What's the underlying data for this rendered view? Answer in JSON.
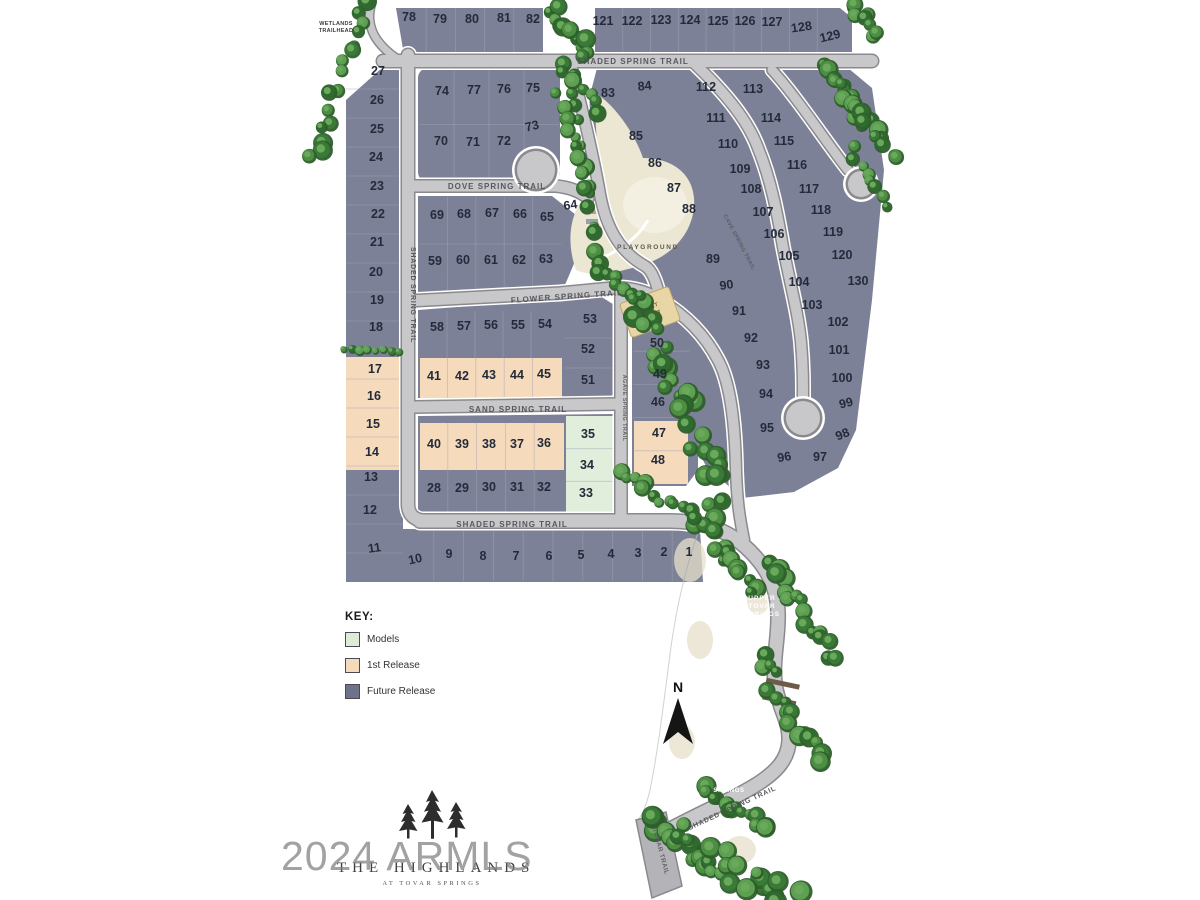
{
  "map": {
    "wetlands_line1": "WETLANDS",
    "wetlands_line2": "TRAILHEAD",
    "playground_label": "PLAYGROUND",
    "sport_court_line1": "SPORT",
    "sport_court_line2": "COURT",
    "upper_springs_line1": "UPPER",
    "upper_springs_line2": "TOVAR",
    "upper_springs_line3": "SPRINGS",
    "middle_springs_line1": "MIDDLE",
    "middle_springs_line2": "TOVAR",
    "middle_springs_line3": "SPRINGS",
    "north_label": "N"
  },
  "streets": {
    "shaded_top": "SHADED SPRING TRAIL",
    "dove": "DOVE SPRING TRAIL",
    "flower": "FLOWER SPRING TRAIL",
    "sand": "SAND SPRING TRAIL",
    "shaded_bottom": "SHADED SPRING TRAIL",
    "shaded_left": "SHADED SPRING TRAIL",
    "agave": "AGAVE SPRING TRAIL",
    "cave": "CAVE SPRING TRAIL",
    "shaded_diag": "SHADED SPRING TRAIL",
    "tovar": "TOVAR TRAIL"
  },
  "legend": {
    "title": "KEY:",
    "items": [
      {
        "label": "Models",
        "color": "#dcedd6",
        "category": "model"
      },
      {
        "label": "1st Release",
        "color": "#f5dabc",
        "category": "first"
      },
      {
        "label": "Future Release",
        "color": "#6f7389",
        "category": "future"
      }
    ]
  },
  "logo": {
    "name": "THE HIGHLANDS",
    "tagline": "AT TOVAR SPRINGS"
  },
  "watermark": "2024 ARMLS",
  "lots": [
    {
      "n": "1",
      "x": 689,
      "y": 556,
      "t": "future"
    },
    {
      "n": "2",
      "x": 664,
      "y": 556,
      "t": "future"
    },
    {
      "n": "3",
      "x": 638,
      "y": 557,
      "t": "future"
    },
    {
      "n": "4",
      "x": 611,
      "y": 558,
      "t": "future"
    },
    {
      "n": "5",
      "x": 581,
      "y": 559,
      "t": "future"
    },
    {
      "n": "6",
      "x": 549,
      "y": 560,
      "t": "future"
    },
    {
      "n": "7",
      "x": 516,
      "y": 560,
      "t": "future"
    },
    {
      "n": "8",
      "x": 483,
      "y": 560,
      "t": "future"
    },
    {
      "n": "9",
      "x": 449,
      "y": 558,
      "t": "future"
    },
    {
      "n": "10",
      "x": 416,
      "y": 563,
      "t": "future",
      "r": -12
    },
    {
      "n": "11",
      "x": 375,
      "y": 552,
      "t": "future",
      "r": -8
    },
    {
      "n": "12",
      "x": 370,
      "y": 514,
      "t": "future"
    },
    {
      "n": "13",
      "x": 371,
      "y": 481,
      "t": "future"
    },
    {
      "n": "14",
      "x": 372,
      "y": 456,
      "t": "first"
    },
    {
      "n": "15",
      "x": 373,
      "y": 428,
      "t": "first"
    },
    {
      "n": "16",
      "x": 374,
      "y": 400,
      "t": "first"
    },
    {
      "n": "17",
      "x": 375,
      "y": 373,
      "t": "first"
    },
    {
      "n": "18",
      "x": 376,
      "y": 331,
      "t": "future"
    },
    {
      "n": "19",
      "x": 377,
      "y": 304,
      "t": "future"
    },
    {
      "n": "20",
      "x": 376,
      "y": 276,
      "t": "future"
    },
    {
      "n": "21",
      "x": 377,
      "y": 246,
      "t": "future"
    },
    {
      "n": "22",
      "x": 378,
      "y": 218,
      "t": "future"
    },
    {
      "n": "23",
      "x": 377,
      "y": 190,
      "t": "future"
    },
    {
      "n": "24",
      "x": 376,
      "y": 161,
      "t": "future"
    },
    {
      "n": "25",
      "x": 377,
      "y": 133,
      "t": "future"
    },
    {
      "n": "26",
      "x": 377,
      "y": 104,
      "t": "future"
    },
    {
      "n": "27",
      "x": 378,
      "y": 75,
      "t": "future"
    },
    {
      "n": "28",
      "x": 434,
      "y": 492,
      "t": "future"
    },
    {
      "n": "29",
      "x": 462,
      "y": 492,
      "t": "future"
    },
    {
      "n": "30",
      "x": 489,
      "y": 491,
      "t": "future"
    },
    {
      "n": "31",
      "x": 517,
      "y": 491,
      "t": "future"
    },
    {
      "n": "32",
      "x": 544,
      "y": 491,
      "t": "future"
    },
    {
      "n": "33",
      "x": 586,
      "y": 497,
      "t": "model"
    },
    {
      "n": "34",
      "x": 587,
      "y": 469,
      "t": "model"
    },
    {
      "n": "35",
      "x": 588,
      "y": 438,
      "t": "model"
    },
    {
      "n": "36",
      "x": 544,
      "y": 447,
      "t": "first"
    },
    {
      "n": "37",
      "x": 517,
      "y": 448,
      "t": "first"
    },
    {
      "n": "38",
      "x": 489,
      "y": 448,
      "t": "first"
    },
    {
      "n": "39",
      "x": 462,
      "y": 448,
      "t": "first"
    },
    {
      "n": "40",
      "x": 434,
      "y": 448,
      "t": "first"
    },
    {
      "n": "41",
      "x": 434,
      "y": 380,
      "t": "first"
    },
    {
      "n": "42",
      "x": 462,
      "y": 380,
      "t": "first"
    },
    {
      "n": "43",
      "x": 489,
      "y": 379,
      "t": "first"
    },
    {
      "n": "44",
      "x": 517,
      "y": 379,
      "t": "first"
    },
    {
      "n": "45",
      "x": 544,
      "y": 378,
      "t": "first"
    },
    {
      "n": "46",
      "x": 658,
      "y": 406,
      "t": "future"
    },
    {
      "n": "47",
      "x": 659,
      "y": 437,
      "t": "first"
    },
    {
      "n": "48",
      "x": 658,
      "y": 464,
      "t": "first"
    },
    {
      "n": "49",
      "x": 660,
      "y": 378,
      "t": "future"
    },
    {
      "n": "50",
      "x": 657,
      "y": 347,
      "t": "future"
    },
    {
      "n": "51",
      "x": 588,
      "y": 384,
      "t": "future"
    },
    {
      "n": "52",
      "x": 588,
      "y": 353,
      "t": "future"
    },
    {
      "n": "53",
      "x": 590,
      "y": 323,
      "t": "future"
    },
    {
      "n": "54",
      "x": 545,
      "y": 328,
      "t": "future"
    },
    {
      "n": "55",
      "x": 518,
      "y": 329,
      "t": "future"
    },
    {
      "n": "56",
      "x": 491,
      "y": 329,
      "t": "future"
    },
    {
      "n": "57",
      "x": 464,
      "y": 330,
      "t": "future"
    },
    {
      "n": "58",
      "x": 437,
      "y": 331,
      "t": "future"
    },
    {
      "n": "59",
      "x": 435,
      "y": 265,
      "t": "future"
    },
    {
      "n": "60",
      "x": 463,
      "y": 264,
      "t": "future"
    },
    {
      "n": "61",
      "x": 491,
      "y": 264,
      "t": "future"
    },
    {
      "n": "62",
      "x": 519,
      "y": 264,
      "t": "future"
    },
    {
      "n": "63",
      "x": 546,
      "y": 263,
      "t": "future"
    },
    {
      "n": "64",
      "x": 571,
      "y": 209,
      "t": "future",
      "r": -8
    },
    {
      "n": "65",
      "x": 547,
      "y": 221,
      "t": "future"
    },
    {
      "n": "66",
      "x": 520,
      "y": 218,
      "t": "future"
    },
    {
      "n": "67",
      "x": 492,
      "y": 217,
      "t": "future"
    },
    {
      "n": "68",
      "x": 464,
      "y": 218,
      "t": "future"
    },
    {
      "n": "69",
      "x": 437,
      "y": 219,
      "t": "future"
    },
    {
      "n": "70",
      "x": 441,
      "y": 145,
      "t": "future"
    },
    {
      "n": "71",
      "x": 473,
      "y": 146,
      "t": "future"
    },
    {
      "n": "72",
      "x": 504,
      "y": 145,
      "t": "future"
    },
    {
      "n": "73",
      "x": 533,
      "y": 130,
      "t": "future",
      "r": -14
    },
    {
      "n": "74",
      "x": 442,
      "y": 95,
      "t": "future"
    },
    {
      "n": "75",
      "x": 533,
      "y": 92,
      "t": "future"
    },
    {
      "n": "76",
      "x": 504,
      "y": 93,
      "t": "future"
    },
    {
      "n": "77",
      "x": 474,
      "y": 94,
      "t": "future"
    },
    {
      "n": "78",
      "x": 409,
      "y": 21,
      "t": "future"
    },
    {
      "n": "79",
      "x": 440,
      "y": 23,
      "t": "future"
    },
    {
      "n": "80",
      "x": 472,
      "y": 23,
      "t": "future"
    },
    {
      "n": "81",
      "x": 504,
      "y": 22,
      "t": "future"
    },
    {
      "n": "82",
      "x": 533,
      "y": 23,
      "t": "future"
    },
    {
      "n": "83",
      "x": 608,
      "y": 97,
      "t": "future"
    },
    {
      "n": "84",
      "x": 645,
      "y": 90,
      "t": "future",
      "r": -6
    },
    {
      "n": "85",
      "x": 636,
      "y": 140,
      "t": "future"
    },
    {
      "n": "86",
      "x": 655,
      "y": 167,
      "t": "future"
    },
    {
      "n": "87",
      "x": 674,
      "y": 192,
      "t": "future"
    },
    {
      "n": "88",
      "x": 689,
      "y": 213,
      "t": "future"
    },
    {
      "n": "89",
      "x": 713,
      "y": 263,
      "t": "future"
    },
    {
      "n": "90",
      "x": 727,
      "y": 289,
      "t": "future",
      "r": -8
    },
    {
      "n": "91",
      "x": 739,
      "y": 315,
      "t": "future"
    },
    {
      "n": "92",
      "x": 751,
      "y": 342,
      "t": "future"
    },
    {
      "n": "93",
      "x": 763,
      "y": 369,
      "t": "future"
    },
    {
      "n": "94",
      "x": 766,
      "y": 398,
      "t": "future"
    },
    {
      "n": "95",
      "x": 767,
      "y": 432,
      "t": "future"
    },
    {
      "n": "96",
      "x": 785,
      "y": 461,
      "t": "future",
      "r": -10
    },
    {
      "n": "97",
      "x": 820,
      "y": 461,
      "t": "future"
    },
    {
      "n": "98",
      "x": 844,
      "y": 438,
      "t": "future",
      "r": -22
    },
    {
      "n": "99",
      "x": 847,
      "y": 407,
      "t": "future",
      "r": -14
    },
    {
      "n": "100",
      "x": 842,
      "y": 382,
      "t": "future"
    },
    {
      "n": "101",
      "x": 839,
      "y": 354,
      "t": "future"
    },
    {
      "n": "102",
      "x": 838,
      "y": 326,
      "t": "future"
    },
    {
      "n": "103",
      "x": 812,
      "y": 309,
      "t": "future"
    },
    {
      "n": "104",
      "x": 799,
      "y": 286,
      "t": "future"
    },
    {
      "n": "105",
      "x": 789,
      "y": 260,
      "t": "future"
    },
    {
      "n": "106",
      "x": 774,
      "y": 238,
      "t": "future"
    },
    {
      "n": "107",
      "x": 763,
      "y": 216,
      "t": "future"
    },
    {
      "n": "108",
      "x": 751,
      "y": 193,
      "t": "future"
    },
    {
      "n": "109",
      "x": 740,
      "y": 173,
      "t": "future"
    },
    {
      "n": "110",
      "x": 728,
      "y": 148,
      "t": "future"
    },
    {
      "n": "111",
      "x": 716,
      "y": 122,
      "t": "future"
    },
    {
      "n": "112",
      "x": 706,
      "y": 91,
      "t": "future"
    },
    {
      "n": "113",
      "x": 753,
      "y": 93,
      "t": "future"
    },
    {
      "n": "114",
      "x": 771,
      "y": 122,
      "t": "future"
    },
    {
      "n": "115",
      "x": 784,
      "y": 145,
      "t": "future"
    },
    {
      "n": "116",
      "x": 797,
      "y": 169,
      "t": "future"
    },
    {
      "n": "117",
      "x": 809,
      "y": 193,
      "t": "future"
    },
    {
      "n": "118",
      "x": 821,
      "y": 214,
      "t": "future"
    },
    {
      "n": "119",
      "x": 833,
      "y": 236,
      "t": "future"
    },
    {
      "n": "120",
      "x": 842,
      "y": 259,
      "t": "future"
    },
    {
      "n": "121",
      "x": 603,
      "y": 25,
      "t": "future"
    },
    {
      "n": "122",
      "x": 632,
      "y": 25,
      "t": "future"
    },
    {
      "n": "123",
      "x": 661,
      "y": 24,
      "t": "future"
    },
    {
      "n": "124",
      "x": 690,
      "y": 24,
      "t": "future"
    },
    {
      "n": "125",
      "x": 718,
      "y": 25,
      "t": "future"
    },
    {
      "n": "126",
      "x": 745,
      "y": 25,
      "t": "future"
    },
    {
      "n": "127",
      "x": 772,
      "y": 26,
      "t": "future"
    },
    {
      "n": "128",
      "x": 802,
      "y": 31,
      "t": "future",
      "r": -8
    },
    {
      "n": "129",
      "x": 831,
      "y": 40,
      "t": "future",
      "r": -14
    },
    {
      "n": "130",
      "x": 858,
      "y": 285,
      "t": "future"
    }
  ]
}
